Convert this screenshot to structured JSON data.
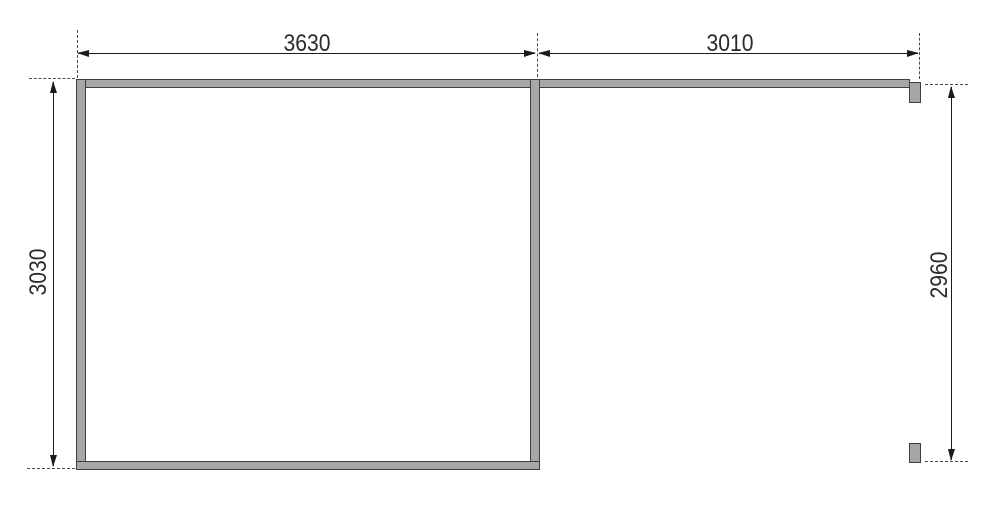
{
  "meta": {
    "type": "technical-drawing",
    "subject": "dimensioned frame plan with closed left room and open right bay"
  },
  "colors": {
    "wall-fill": "#a7a7a7",
    "wall-line": "#3f3f3f",
    "dim-line": "#1a1a1a",
    "dash-line": "#4a4a4a",
    "text-col": "#2b2b2b",
    "bg": "#ffffff"
  },
  "dimensions": {
    "top_left_width": "3630",
    "top_right_width": "3010",
    "left_height": "3030",
    "right_height": "2960"
  }
}
